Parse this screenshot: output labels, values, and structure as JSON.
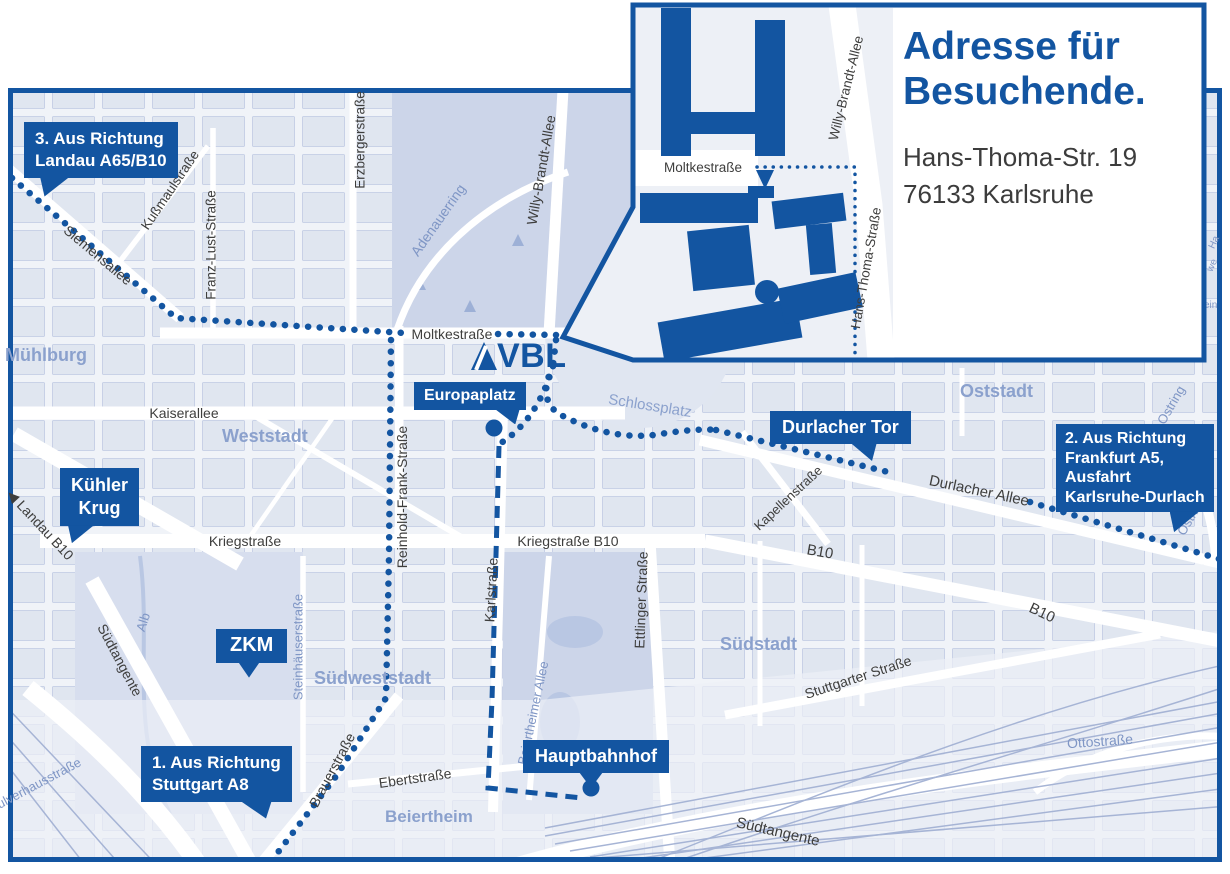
{
  "colors": {
    "brand_blue": "#1355a1",
    "map_background": "#f0f3f8",
    "park": "#ccd5e9",
    "district_text": "#8ba1cd",
    "street_text": "#3e3e3d",
    "light_street_text": "#7f96c5"
  },
  "inset": {
    "title_lines": [
      "Adresse für",
      "Besuchende."
    ],
    "address_lines": [
      "Hans-Thoma-Str. 19",
      "76133 Karlsruhe"
    ],
    "streets": {
      "moltkestrasse": "Moltkestraße",
      "willy_brandt_allee": "Willy-Brandt-Allee",
      "hans_thoma_strasse": "Hans-Thoma-Straße"
    }
  },
  "logo": {
    "text": "VBL"
  },
  "callouts": {
    "landau": {
      "lines": [
        "3. Aus Richtung",
        "Landau A65/B10"
      ]
    },
    "frankfurt": {
      "lines": [
        "2. Aus Richtung",
        "Frankfurt A5,",
        "Ausfahrt",
        "Karlsruhe-Durlach"
      ]
    },
    "stuttgart": {
      "lines": [
        "1. Aus Richtung",
        "Stuttgart A8"
      ]
    },
    "kuehler_krug": {
      "lines": [
        "Kühler",
        "Krug"
      ]
    },
    "zkm": {
      "lines": [
        "ZKM"
      ]
    },
    "europaplatz": {
      "lines": [
        "Europaplatz"
      ]
    },
    "durlacher_tor": {
      "lines": [
        "Durlacher Tor"
      ]
    },
    "hauptbahnhof": {
      "lines": [
        "Hauptbahnhof"
      ]
    }
  },
  "streets": {
    "moltkestrasse": "Moltkestraße",
    "kaiserallee": "Kaiserallee",
    "kriegstrasse": "Kriegstraße",
    "kriegstrasse_b10": "Kriegstraße B10",
    "siemensallee": "Siemensallee",
    "kussmaulstrasse": "Kußmaulstraße",
    "franz_lust_strasse": "Franz-Lust-Straße",
    "erzbergerstrasse": "Erzbergerstraße",
    "willy_brandt_allee": "Willy-Brandt-Allee",
    "adenauerring": "Adenauerring",
    "reinhold_frank_strasse": "Reinhold-Frank-Straße",
    "karlstrasse": "Karlstraße",
    "ettlinger_strasse": "Ettlinger Straße",
    "landau_arrow": "◀",
    "landau_b10": "Landau B10",
    "suedtangente": "Südtangente",
    "brauerstrasse": "Brauerstraße",
    "ebertstrasse": "Ebertstraße",
    "stuttgarter_strasse": "Stuttgarter Straße",
    "durlacher_allee": "Durlacher Allee",
    "kapellenstrasse": "Kapellenstraße",
    "b10": "B10",
    "alb": "Alb",
    "steinhaeuserstrasse": "Steinhäuserstraße",
    "beiertheimer_allee": "Beiertheimer Allee",
    "ottostrasse": "Ottostraße",
    "ostring": "Ostring",
    "pulverhausstrasse": "Pulverhausstraße",
    "schlossplatz": "Schlossplatz"
  },
  "districts": {
    "muehlburg": "Mühlburg",
    "weststadt": "Weststadt",
    "oststadt": "Oststadt",
    "suedstadt": "Südstadt",
    "suedweststadt": "Südweststadt",
    "beiertheim": "Beiertheim"
  },
  "edge_fragments": [
    "Ha",
    "we",
    "ein"
  ]
}
